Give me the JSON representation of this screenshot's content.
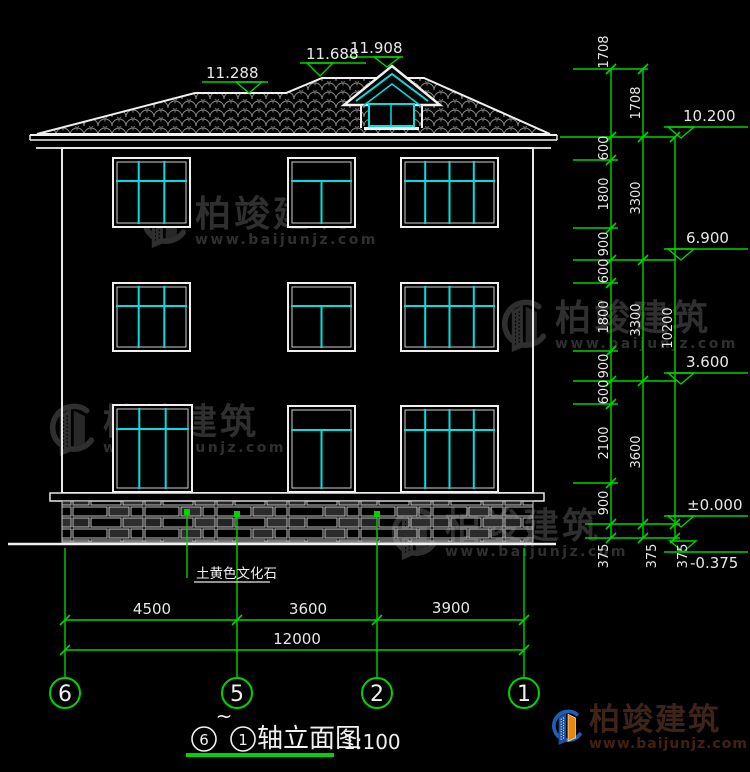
{
  "roof_markers": [
    "11.288",
    "11.688",
    "11.908"
  ],
  "right_markers": [
    "10.200",
    "6.900",
    "3.600",
    "±0.000",
    "-0.375"
  ],
  "dims": {
    "inner": [
      "1708",
      "600",
      "1800",
      "900",
      "600",
      "1800",
      "900",
      "600",
      "2100",
      "900",
      "375"
    ],
    "middle": [
      "1708",
      "3300",
      "3300",
      "3600",
      "375"
    ],
    "outer": [
      "10200",
      "375"
    ],
    "bottom": [
      "4500",
      "3600",
      "3900"
    ],
    "bottom_total": "12000"
  },
  "grid_bubbles": [
    "6",
    "5",
    "2",
    "1"
  ],
  "material_label": "土黄色文化石",
  "title": {
    "from": "6",
    "tilde": "~",
    "to": "1",
    "name": "轴立面图",
    "scale": "1:100"
  },
  "watermark": {
    "name": "柏竣建筑",
    "url": "www.baijunjz.com"
  },
  "logo": {
    "name": "柏竣建筑",
    "url": "www.baijunjz.com"
  },
  "colors": {
    "background": "#000000",
    "dimension_green": "#00d400",
    "window_cyan": "#00e0e0",
    "drawing_white": "#f0f0f0",
    "tile_gray": "#8a8a8a",
    "watermark_gray": "#2f2f2f",
    "logo_blue": "#1d5fb8",
    "logo_orange": "#e8870f",
    "logo_text_brown": "#3d2318"
  }
}
